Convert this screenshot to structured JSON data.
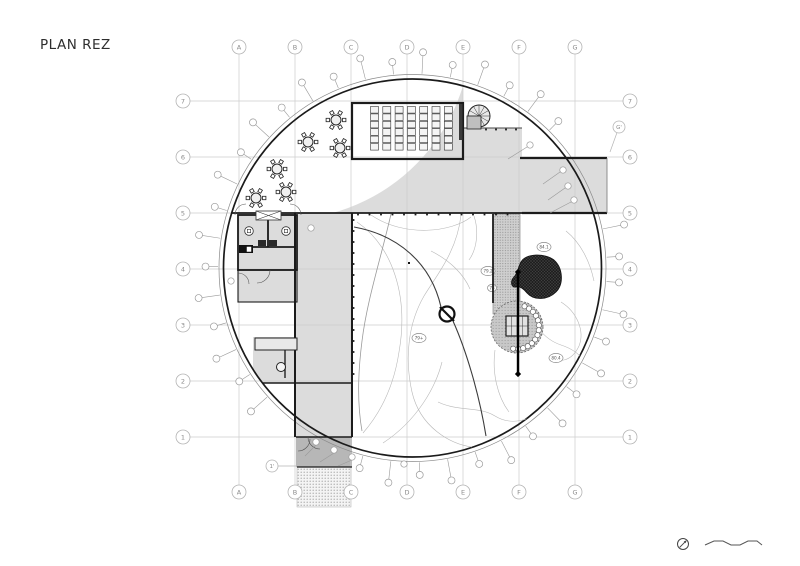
{
  "title": "PLAN REZ",
  "colors": {
    "paper": "#ffffff",
    "grid": "#cccccc",
    "bubble_stroke": "#b4b4b4",
    "bubble_text": "#8a8a8a",
    "floor": "#dcdcdc",
    "floor_dark": "#b7b7b7",
    "wall": "#1b1b1b",
    "wall_light": "#6e6e6e",
    "contour": "#b8b8b8",
    "contour_mid": "#9a9a9a",
    "contour_dark": "#3c3c3c",
    "pond": "#202020",
    "marker": "#9a9a9a",
    "furniture": "#222222",
    "title_color": "#2e2e2e"
  },
  "grid": {
    "columns": [
      {
        "label": "A",
        "x": 239
      },
      {
        "label": "B",
        "x": 295
      },
      {
        "label": "C",
        "x": 351
      },
      {
        "label": "D",
        "x": 407
      },
      {
        "label": "E",
        "x": 463
      },
      {
        "label": "F",
        "x": 519
      },
      {
        "label": "G",
        "x": 575
      }
    ],
    "rows": [
      {
        "label": "7",
        "y": 101
      },
      {
        "label": "6",
        "y": 157
      },
      {
        "label": "5",
        "y": 213
      },
      {
        "label": "4",
        "y": 269
      },
      {
        "label": "3",
        "y": 325
      },
      {
        "label": "2",
        "y": 381
      },
      {
        "label": "1",
        "y": 437
      }
    ],
    "bubble_r": 7,
    "top_y": 47,
    "bottom_y": 492,
    "left_x": 183,
    "right_x": 630,
    "aux": [
      {
        "label": "G'",
        "x": 619,
        "y": 127,
        "lx": 610,
        "ly": 152
      },
      {
        "label": "1'",
        "x": 272,
        "y": 466,
        "lx": 296,
        "ly": 466
      }
    ]
  },
  "circle": {
    "cx": 412.5,
    "cy": 268,
    "r": 189,
    "outer_r": 193.5
  },
  "built": {
    "upper_path": "M 231.7 213 A 189 189 0 0 0 463 85.9 L 463 128 L 522 128 L 522 213 Z",
    "wing": {
      "x": 520,
      "y": 158,
      "w": 87,
      "h": 55
    },
    "band": {
      "x": 295,
      "y": 213,
      "w": 57,
      "h": 224
    },
    "toilet_block": {
      "x": 238,
      "y": 215,
      "w": 59,
      "h": 87
    },
    "lower_left": {
      "x": 253,
      "y": 337,
      "w": 99,
      "h": 46
    },
    "vestibule": {
      "x": 296,
      "y": 437,
      "w": 56,
      "h": 30
    },
    "walkway": {
      "x": 297,
      "y": 467,
      "w": 54,
      "h": 40
    }
  },
  "walls": [
    {
      "x1": 295,
      "y1": 213,
      "x2": 295,
      "y2": 437,
      "w": 2
    },
    {
      "x1": 352,
      "y1": 213,
      "x2": 352,
      "y2": 437,
      "w": 2
    },
    {
      "x1": 231.7,
      "y1": 213,
      "x2": 522,
      "y2": 213,
      "w": 1.8
    },
    {
      "x1": 520,
      "y1": 158,
      "x2": 607,
      "y2": 158,
      "w": 2.2
    },
    {
      "x1": 522,
      "y1": 213,
      "x2": 607,
      "y2": 213,
      "w": 2.2
    },
    {
      "x1": 607,
      "y1": 158,
      "x2": 607,
      "y2": 213,
      "w": 0.8,
      "c": "#777777"
    },
    {
      "x1": 463,
      "y1": 128,
      "x2": 522,
      "y2": 128,
      "w": 1,
      "c": "#444444"
    },
    {
      "x1": 493,
      "y1": 214,
      "x2": 493,
      "y2": 303,
      "w": 1.8
    },
    {
      "x1": 262,
      "y1": 383,
      "x2": 352,
      "y2": 383,
      "w": 1.4
    },
    {
      "x1": 296,
      "y1": 437,
      "x2": 352,
      "y2": 437,
      "w": 1.5
    },
    {
      "x1": 297,
      "y1": 467,
      "x2": 352,
      "y2": 467,
      "w": 1.2
    }
  ],
  "ticks": [
    {
      "dir": "h",
      "y": 214.5,
      "a1": 358,
      "a2": 516,
      "step": 11.5
    },
    {
      "dir": "v",
      "x": 353.5,
      "a1": 220,
      "a2": 378,
      "step": 11
    },
    {
      "dir": "h",
      "y": 129.5,
      "a1": 486,
      "a2": 518,
      "step": 10
    }
  ],
  "classroom": {
    "x": 352,
    "y": 103,
    "w": 111,
    "h": 56,
    "cols": 7,
    "col_start": 370.5,
    "col_step": 12.3,
    "col_w": 8,
    "rows": 6,
    "row_start": 106.5,
    "cell_h": 6.6,
    "cell_gap": 0.8,
    "hatch": {
      "x": 459,
      "y": 104,
      "w": 3.5,
      "h": 36
    }
  },
  "stair": {
    "cx": 479,
    "cy": 116,
    "r": 11,
    "spokes": 12,
    "box": {
      "x": 467,
      "y": 116,
      "w": 14,
      "h": 13
    }
  },
  "tables": [
    {
      "x": 336,
      "y": 120
    },
    {
      "x": 308,
      "y": 142
    },
    {
      "x": 340,
      "y": 148
    },
    {
      "x": 277,
      "y": 169
    },
    {
      "x": 286,
      "y": 192
    },
    {
      "x": 256,
      "y": 198
    }
  ],
  "table_style": {
    "r": 5,
    "chair_ring": 8.2,
    "chairs": 6,
    "chair_size": 3.4
  },
  "toilets": {
    "outer": {
      "x": 238,
      "y": 215,
      "w": 59,
      "h": 55
    },
    "mid_wall": {
      "x": 268,
      "y1": 216,
      "y2": 247
    },
    "shelf": {
      "y": 247,
      "x1": 239,
      "x2": 296
    },
    "xbox": {
      "x": 256,
      "y": 211,
      "w": 25,
      "h": 9
    },
    "basins": [
      {
        "x": 249,
        "y": 231
      },
      {
        "x": 286,
        "y": 231
      }
    ],
    "wcs": [
      {
        "x": 258,
        "y": 240,
        "w": 8,
        "h": 6
      },
      {
        "x": 269,
        "y": 240,
        "w": 8,
        "h": 6
      }
    ],
    "black_unit": {
      "x": 239,
      "y": 245,
      "w": 14,
      "h": 8
    },
    "white_inset": {
      "x": 246.5,
      "y": 246.5,
      "w": 5,
      "h": 5.5
    },
    "lower_room": {
      "x": 238,
      "y": 270,
      "w": 59,
      "h": 32
    },
    "door_arcs": [
      {
        "cx": 246,
        "cy": 215,
        "r": 11,
        "a1": 180,
        "a2": 270
      },
      {
        "cx": 290,
        "cy": 215,
        "r": 11,
        "a1": 270,
        "a2": 360
      },
      {
        "cx": 257,
        "cy": 270,
        "r": 13,
        "a1": 0,
        "a2": 90
      },
      {
        "cx": 238,
        "cy": 284,
        "r": 11,
        "a1": 270,
        "a2": 360
      },
      {
        "cx": 298,
        "cy": 439,
        "r": 12,
        "a1": 0,
        "a2": 90
      },
      {
        "cx": 320,
        "cy": 437,
        "r": 12,
        "a1": 90,
        "a2": 180
      }
    ]
  },
  "counter": {
    "rect": {
      "x": 255,
      "y": 338,
      "w": 42,
      "h": 12
    },
    "wall": {
      "x1": 285,
      "y1": 350,
      "x2": 285,
      "y2": 378
    },
    "item": {
      "x": 281,
      "y": 367,
      "r": 4.5
    }
  },
  "courtyard": {
    "strip": {
      "x": 493,
      "y": 214,
      "w": 27,
      "h": 100
    },
    "planted": {
      "cx": 517,
      "cy": 327,
      "r": 26,
      "pebble_r": 2.6,
      "pebble_ring_r": 22,
      "pebble_a1": -70,
      "pebble_a2": 100,
      "pebbles": 14,
      "pavilion": {
        "x": 506,
        "y": 316,
        "w": 22,
        "h": 20
      }
    },
    "pond": "M521,262 C526,253 545,253 554,260 C563,268 564,284 556,292 C548,300 534,301 527,293 C523,288 519,286 516,287 C511,288 510,281 514,277 C518,273 518,267 521,262 Z",
    "section_line": {
      "x": 518,
      "y1": 272,
      "y2": 374
    },
    "no_symbol": {
      "cx": 447,
      "cy": 314,
      "r": 7.5
    },
    "spot_levels": [
      {
        "label": "79.2",
        "x": 488,
        "y": 271,
        "rx": 7,
        "ry": 4.6
      },
      {
        "label": "78",
        "x": 492,
        "y": 288,
        "rx": 4.5,
        "ry": 3.6
      },
      {
        "label": "79+",
        "x": 419,
        "y": 338,
        "rx": 7,
        "ry": 4.6
      },
      {
        "label": "84.1",
        "x": 544,
        "y": 247,
        "rx": 7,
        "ry": 4.6
      },
      {
        "label": "80.4",
        "x": 556,
        "y": 358,
        "rx": 7,
        "ry": 4.6
      }
    ],
    "dot": {
      "x": 408,
      "y": 262
    },
    "contours_light": [
      "M357,222 C392,246 409,295 399,352 C393,392 376,418 363,433",
      "M371,215 C405,238 452,232 471,217",
      "M383,443 C418,420 436,386 442,362",
      "M461,215 C457,252 436,276 424,296 C409,322 404,356 412,392 C420,427 450,444 472,447",
      "M561,302 C577,312 585,331 579,346 C571,363 557,362 556,357",
      "M566,231 C581,243 590,262 594,281",
      "M527,302 C531,322 543,339 561,345 C579,351 589,362 584,376",
      "M431,251 C451,261 464,275 470,289",
      "M438,402 C459,412 479,406 495,416 C511,426 532,421 546,406",
      "M474,216 C479,231 477,249 469,260",
      "M495,350 C492,372 497,396 509,412"
    ],
    "contours_mid": [
      "M391,214 C381,258 367,300 362,341 C358,372 357,403 362,431"
    ],
    "contours_dark": [
      "M354,227 C398,235 431,263 441,307",
      "M453,321 C466,350 479,393 486,436"
    ]
  },
  "tiny_bubbles": [
    {
      "x": 563,
      "y": 170
    },
    {
      "x": 568,
      "y": 186
    },
    {
      "x": 574,
      "y": 200
    },
    {
      "x": 316,
      "y": 442
    },
    {
      "x": 334,
      "y": 450
    },
    {
      "x": 352,
      "y": 457
    },
    {
      "x": 404,
      "y": 464
    },
    {
      "x": 231,
      "y": 281
    },
    {
      "x": 311,
      "y": 228
    },
    {
      "x": 530,
      "y": 145
    }
  ],
  "leaders": [
    {
      "x1": 560,
      "y1": 172,
      "x2": 543,
      "y2": 184
    },
    {
      "x1": 565,
      "y1": 188,
      "x2": 548,
      "y2": 200
    },
    {
      "x1": 571,
      "y1": 202,
      "x2": 550,
      "y2": 213
    },
    {
      "x1": 316,
      "y1": 445,
      "x2": 305,
      "y2": 456
    },
    {
      "x1": 334,
      "y1": 453,
      "x2": 320,
      "y2": 462
    },
    {
      "x1": 352,
      "y1": 460,
      "x2": 338,
      "y2": 466
    },
    {
      "x1": 527,
      "y1": 147,
      "x2": 508,
      "y2": 159
    }
  ],
  "perimeter_markers": {
    "step_deg": 8.4,
    "start_deg": 4,
    "r_inner": 207,
    "r_outer": 216,
    "dot_r": 3.5,
    "skip": [
      [
        -38,
        -14
      ],
      [
        106,
        131
      ]
    ]
  },
  "compass": {
    "cx": 683,
    "cy": 544,
    "r": 5.5
  },
  "scalebar": {
    "path": "M705,545 L714,541 L723,541 L731,545 L740,545 L748,541 L757,541 L762,545"
  }
}
